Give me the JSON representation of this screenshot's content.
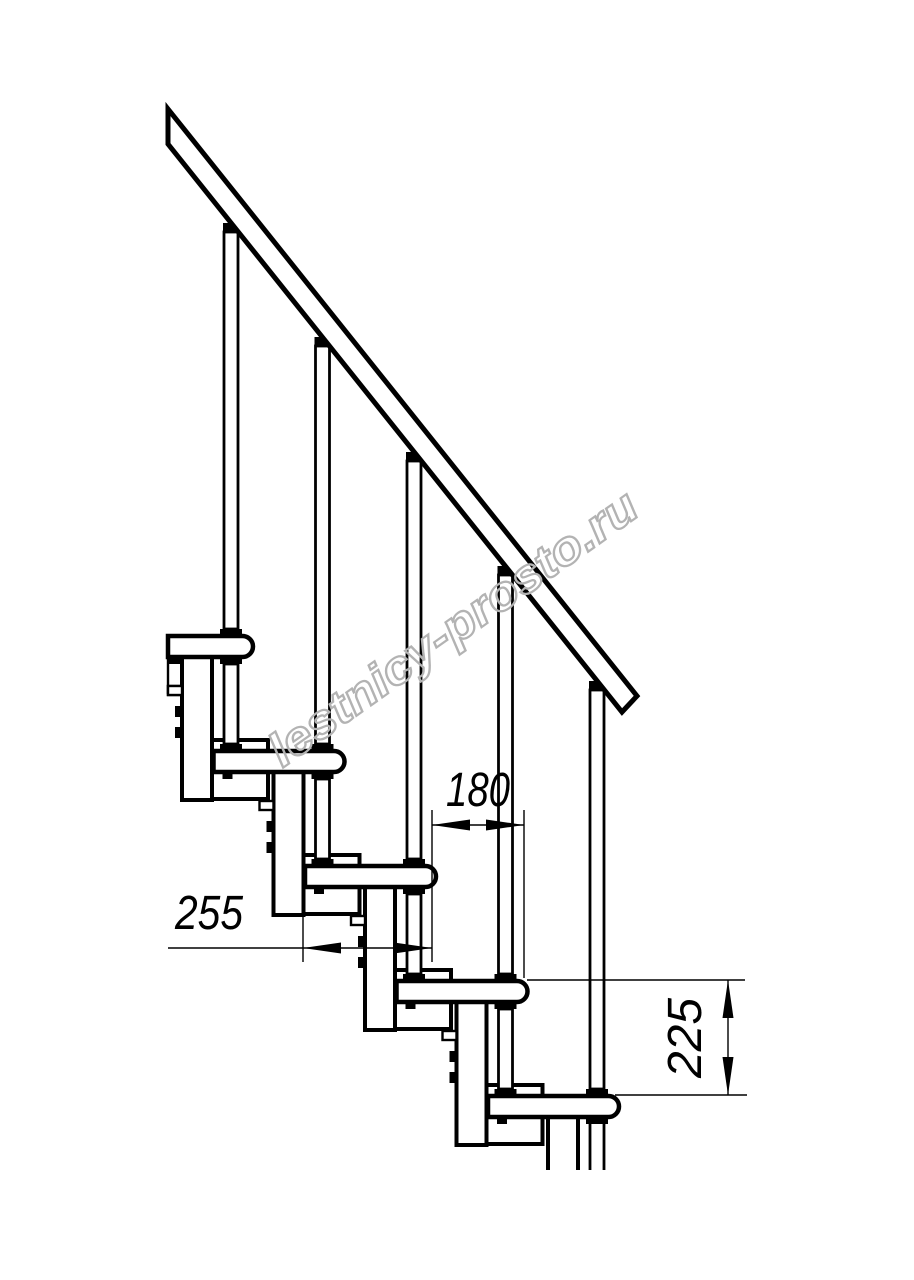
{
  "watermark": {
    "text": "lestnicy-prosto.ru",
    "color": "#b3b3b3"
  },
  "dimensions": {
    "tread_depth": {
      "value": "255"
    },
    "step_going": {
      "value": "180"
    },
    "step_height": {
      "value": "225"
    }
  },
  "drawing": {
    "line_color": "#000000",
    "background": "#ffffff"
  }
}
